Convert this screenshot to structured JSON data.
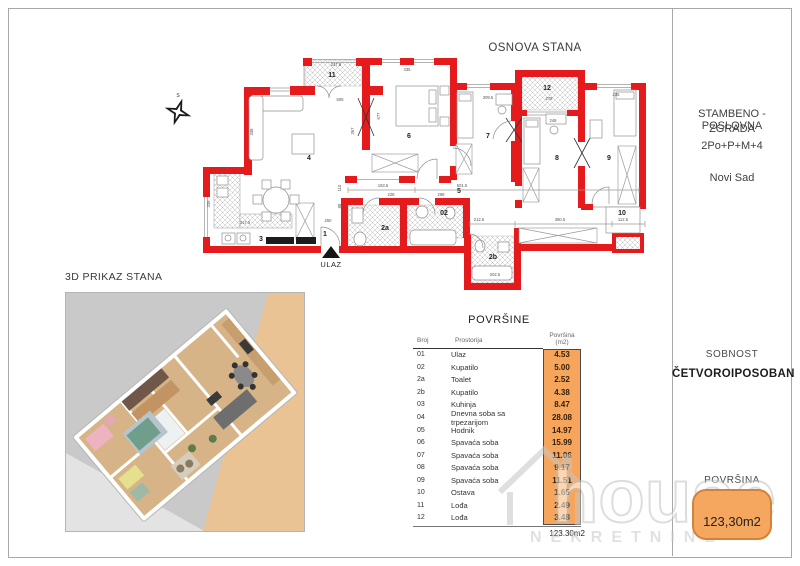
{
  "page": {
    "plan_title": "OSNOVA STANA",
    "view3d_title": "3D PRIKAZ STANA"
  },
  "sidebar": {
    "building_line1": "STAMBENO - POSLOVNA",
    "building_line2": "ZGRADA",
    "building_line3": "2Po+P+M+4",
    "city": "Novi Sad",
    "rooms_label": "SOBNOST",
    "rooms_value": "ČETVOROIPOSOBAN",
    "area_label": "POVRŠINA",
    "area_value": "123,30m2"
  },
  "watermark": {
    "brand": "house",
    "sub": "NEKRETNINE"
  },
  "table": {
    "title": "POVRŠINE",
    "col_broj": "Broj",
    "col_prostorija": "Prostorija",
    "col_povrsina_line1": "Površina",
    "col_povrsina_line2": "(m2)",
    "rows": [
      {
        "broj": "01",
        "prostorija": "Ulaz",
        "povrsina": "4.53"
      },
      {
        "broj": "02",
        "prostorija": "Kupatilo",
        "povrsina": "5.00"
      },
      {
        "broj": "2a",
        "prostorija": "Toalet",
        "povrsina": "2.52"
      },
      {
        "broj": "2b",
        "prostorija": "Kupatilo",
        "povrsina": "4.38"
      },
      {
        "broj": "03",
        "prostorija": "Kuhinja",
        "povrsina": "8.47"
      },
      {
        "broj": "04",
        "prostorija": "Dnevna soba sa trpezarijom",
        "povrsina": "28.08"
      },
      {
        "broj": "05",
        "prostorija": "Hodnik",
        "povrsina": "14.97"
      },
      {
        "broj": "06",
        "prostorija": "Spavaća soba",
        "povrsina": "15.99"
      },
      {
        "broj": "07",
        "prostorija": "Spavaća soba",
        "povrsina": "11.06"
      },
      {
        "broj": "08",
        "prostorija": "Spavaća soba",
        "povrsina": "9.17"
      },
      {
        "broj": "09",
        "prostorija": "Spavaća soba",
        "povrsina": "11.51"
      },
      {
        "broj": "10",
        "prostorija": "Ostava",
        "povrsina": "1.65"
      },
      {
        "broj": "11",
        "prostorija": "Lođa",
        "povrsina": "2.49"
      },
      {
        "broj": "12",
        "prostorija": "Lođa",
        "povrsina": "3.48"
      }
    ],
    "total": "123.30m2"
  },
  "floorplan": {
    "entrance_label": "ULAZ",
    "compass_label": "S",
    "room_labels": [
      {
        "t": "11",
        "x": 332,
        "y": 77
      },
      {
        "t": "12",
        "x": 547,
        "y": 90
      },
      {
        "t": "4",
        "x": 309,
        "y": 160,
        "s": 8
      },
      {
        "t": "6",
        "x": 409,
        "y": 138,
        "s": 8
      },
      {
        "t": "7",
        "x": 488,
        "y": 138,
        "s": 8
      },
      {
        "t": "8",
        "x": 557,
        "y": 160,
        "s": 8
      },
      {
        "t": "9",
        "x": 609,
        "y": 160,
        "s": 8
      },
      {
        "t": "5",
        "x": 459,
        "y": 193
      },
      {
        "t": "1",
        "x": 325,
        "y": 236
      },
      {
        "t": "2a",
        "x": 385,
        "y": 230
      },
      {
        "t": "02",
        "x": 444,
        "y": 215
      },
      {
        "t": "2b",
        "x": 493,
        "y": 259
      },
      {
        "t": "3",
        "x": 261,
        "y": 241
      },
      {
        "t": "10",
        "x": 622,
        "y": 215
      }
    ],
    "dim_labels": [
      {
        "t": "505",
        "x": 340,
        "y": 101
      },
      {
        "t": "247.6",
        "x": 336,
        "y": 66
      },
      {
        "t": "335",
        "x": 407,
        "y": 71
      },
      {
        "t": "309.5",
        "x": 488,
        "y": 99
      },
      {
        "t": "235",
        "x": 616,
        "y": 96
      },
      {
        "t": "278",
        "x": 549,
        "y": 100
      },
      {
        "t": "248",
        "x": 553,
        "y": 122
      },
      {
        "t": "170.6",
        "x": 221,
        "y": 170
      },
      {
        "t": "163.5",
        "x": 383,
        "y": 187
      },
      {
        "t": "501.5",
        "x": 462,
        "y": 187
      },
      {
        "t": "228",
        "x": 391,
        "y": 196
      },
      {
        "t": "298",
        "x": 441,
        "y": 196
      },
      {
        "t": "212.5",
        "x": 479,
        "y": 221
      },
      {
        "t": "380.5",
        "x": 560,
        "y": 221
      },
      {
        "t": "112.5",
        "x": 623,
        "y": 221
      },
      {
        "t": "317.5",
        "x": 245,
        "y": 224
      },
      {
        "t": "250",
        "x": 328,
        "y": 222
      },
      {
        "t": "202.5",
        "x": 495,
        "y": 276
      },
      {
        "t": "677",
        "x": 380,
        "y": 116,
        "r": 1
      },
      {
        "t": "367",
        "x": 354,
        "y": 131,
        "r": 1
      },
      {
        "t": "338",
        "x": 253,
        "y": 132,
        "r": 1
      },
      {
        "t": "339",
        "x": 210,
        "y": 204,
        "r": 1
      },
      {
        "t": "110",
        "x": 341,
        "y": 188,
        "r": 1
      },
      {
        "t": "88",
        "x": 341,
        "y": 206,
        "r": 1
      }
    ]
  },
  "colors": {
    "wall_red": "#e51a1d",
    "accent_orange": "#f6a55c",
    "badge_border": "#d2833b",
    "bg_tan_3d": "#e9c394",
    "bg_gray_3d": "#c9c9c9",
    "watermark_gray": "#c9c9c9"
  }
}
